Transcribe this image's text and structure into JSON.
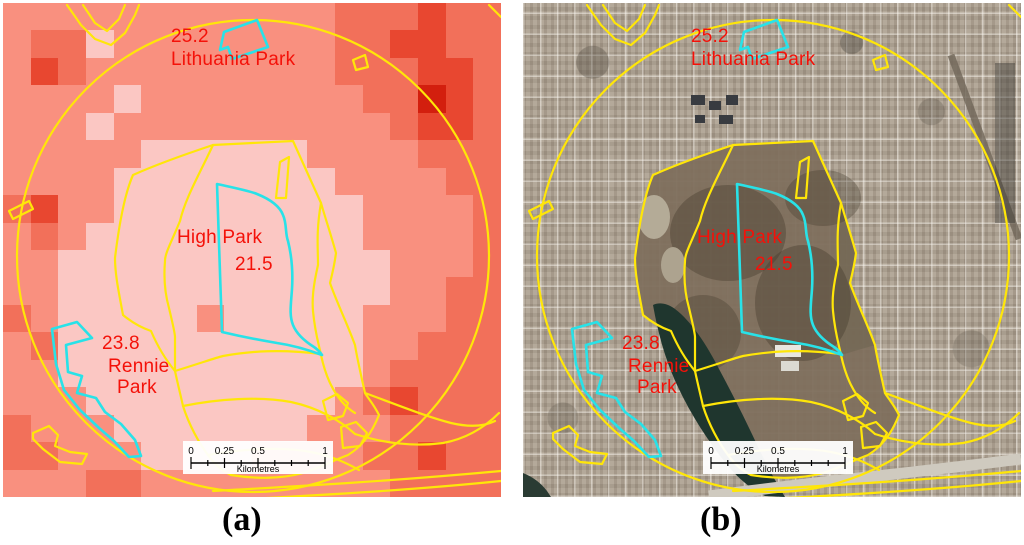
{
  "figure": {
    "caption_a": "(a)",
    "caption_b": "(b)",
    "labels": {
      "lithuania_value": "25.2",
      "lithuania_name": "Lithuania Park",
      "highpark_name": "High Park",
      "highpark_value": "21.5",
      "rennie_value": "23.8",
      "rennie_name_line1": "Rennie",
      "rennie_name_line2": "Park"
    },
    "scalebar": {
      "tick0": "0",
      "tick1": "0.25",
      "tick2": "0.5",
      "tick3": "1",
      "unit": "Kilometres"
    },
    "colors": {
      "label_red": "#f41109",
      "boundary_yellow": "#ffe608",
      "highlight_cyan": "#28e2e8",
      "pond_green": "#1f362e",
      "park_brown": "#7e6f5d"
    },
    "panel_a": {
      "type": "temperature-heatmap",
      "palette": {
        "0": "#F9907F",
        "1": "#FBC7C3",
        "3": "#F2705A",
        "4": "#E84730",
        "5": "#D31F0E"
      },
      "heat_grid": [
        "000000000000333433",
        "033100000000334433",
        "043000000000333443",
        "000010000000033543",
        "000100000000003443",
        "000001111110000333",
        "000011111111000033",
        "340011111111100003",
        "030111111111100003",
        "001111111111110003",
        "001111111111110033",
        "301111101111100033",
        "031111111111100333",
        "001111111111103333",
        "000111111111034333",
        "300011111110003333",
        "330001111000033433",
        "000330000000003333"
      ]
    },
    "panel_b": {
      "type": "aerial-photo"
    }
  }
}
